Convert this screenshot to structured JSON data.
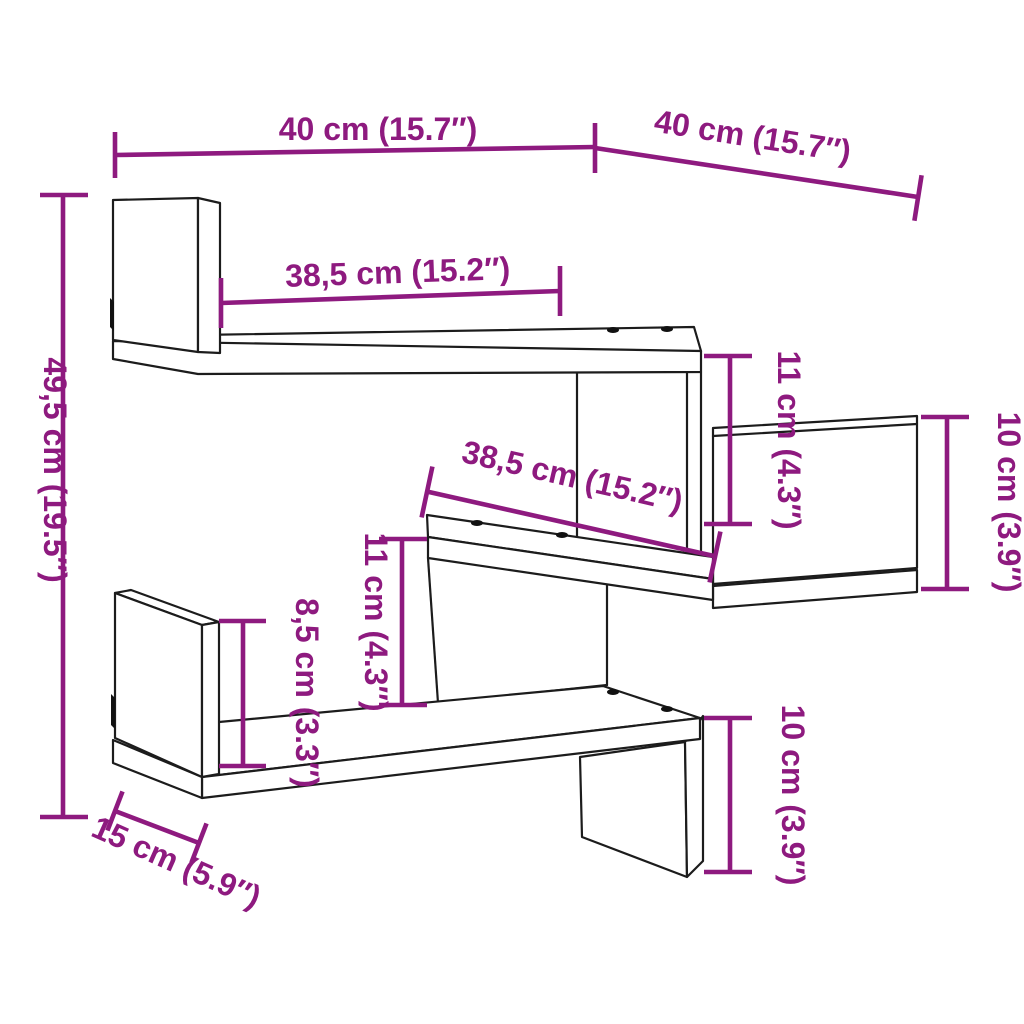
{
  "diagram": {
    "type": "product-dimension-diagram",
    "subject": "corner wall shelf line drawing",
    "colors": {
      "dimension_accent": "#8e1a7f",
      "outline": "#1c1c1c",
      "background": "#ffffff"
    },
    "units": {
      "primary": "cm",
      "secondary": "inches"
    },
    "dimensions": [
      {
        "id": "width-top-left",
        "label": "40 cm (15.7″)",
        "value_cm": 40,
        "value_in": 15.7,
        "orientation": "horizontal"
      },
      {
        "id": "width-top-right",
        "label": "40 cm (15.7″)",
        "value_cm": 40,
        "value_in": 15.7,
        "orientation": "diagonal"
      },
      {
        "id": "shelf-upper",
        "label": "38,5 cm (15.2″)",
        "value_cm": 38.5,
        "value_in": 15.2,
        "orientation": "horizontal"
      },
      {
        "id": "height-total",
        "label": "49,5 cm (19.5″)",
        "value_cm": 49.5,
        "value_in": 19.5,
        "orientation": "vertical"
      },
      {
        "id": "gap-upper",
        "label": "11 cm (4.3″)",
        "value_cm": 11,
        "value_in": 4.3,
        "orientation": "vertical"
      },
      {
        "id": "panel-right",
        "label": "10 cm (3.9″)",
        "value_cm": 10,
        "value_in": 3.9,
        "orientation": "vertical"
      },
      {
        "id": "shelf-middle",
        "label": "38,5 cm (15.2″)",
        "value_cm": 38.5,
        "value_in": 15.2,
        "orientation": "diagonal"
      },
      {
        "id": "gap-middle",
        "label": "11 cm (4.3″)",
        "value_cm": 11,
        "value_in": 4.3,
        "orientation": "vertical"
      },
      {
        "id": "panel-lower-left",
        "label": "8,5 cm (3.3″)",
        "value_cm": 8.5,
        "value_in": 3.3,
        "orientation": "vertical"
      },
      {
        "id": "panel-bottom",
        "label": "10 cm (3.9″)",
        "value_cm": 10,
        "value_in": 3.9,
        "orientation": "vertical"
      },
      {
        "id": "depth",
        "label": "15 cm (5.9″)",
        "value_cm": 15,
        "value_in": 5.9,
        "orientation": "diagonal"
      }
    ]
  }
}
